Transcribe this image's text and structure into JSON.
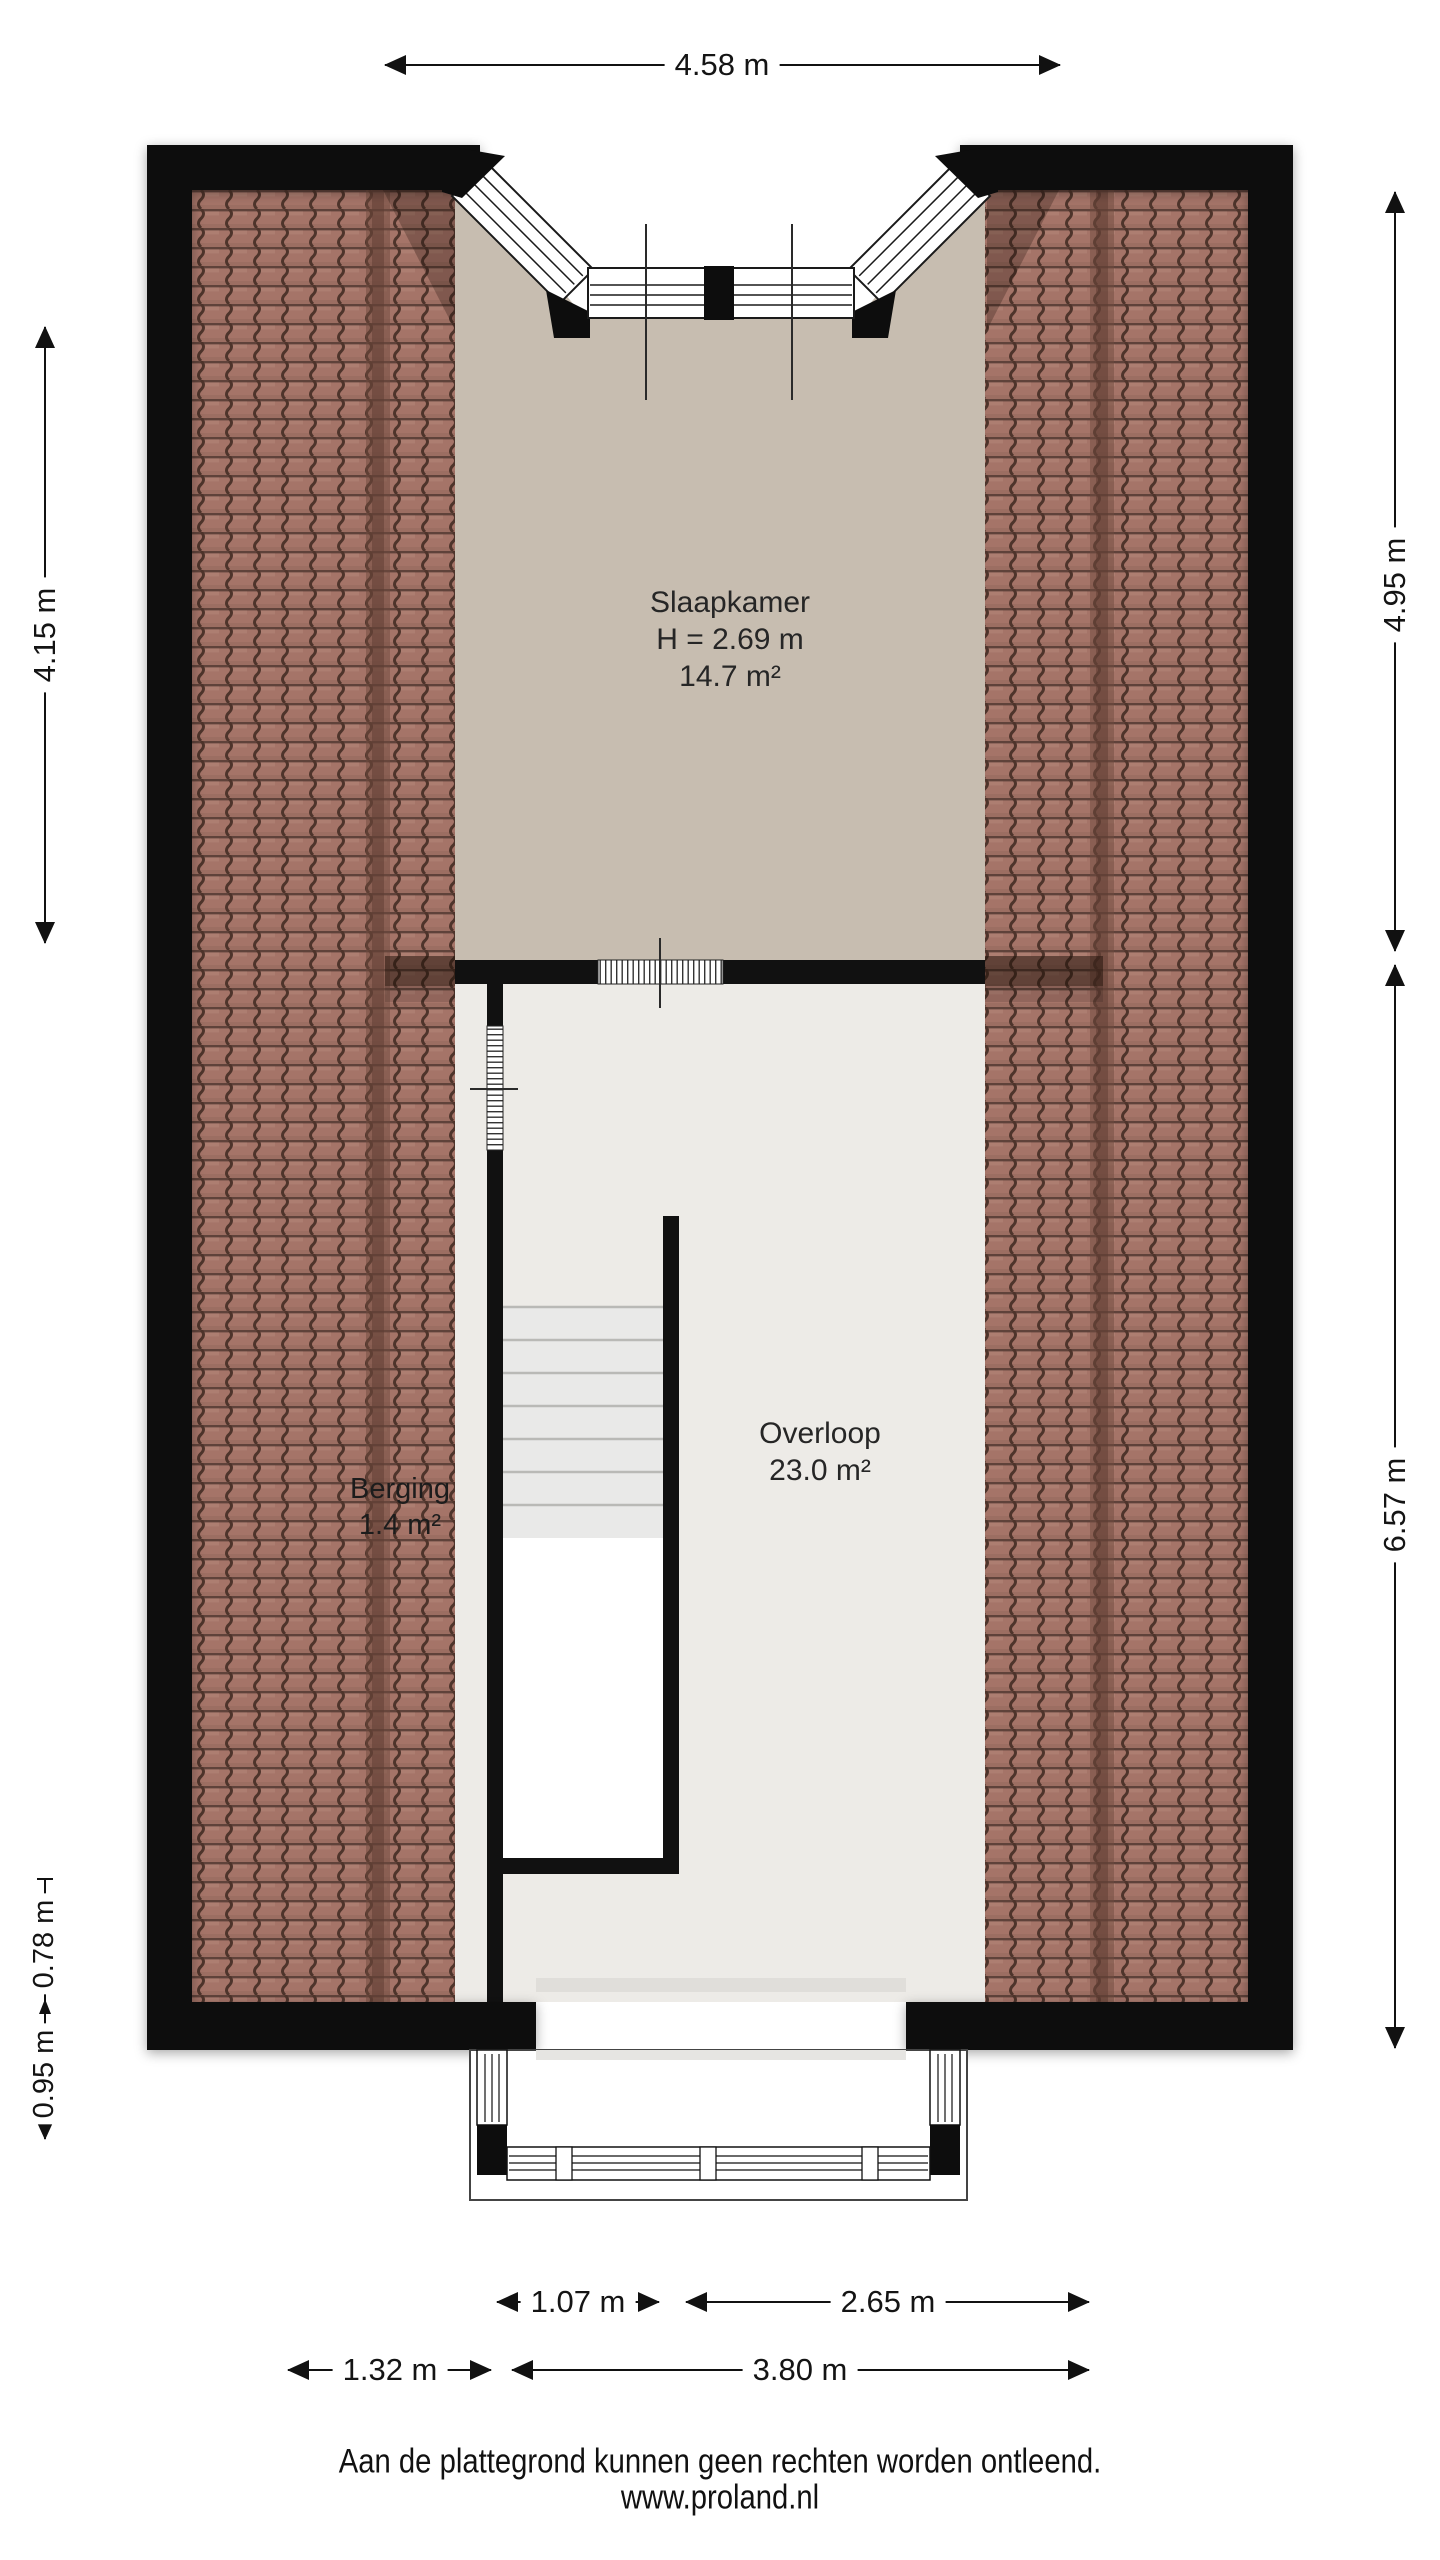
{
  "dimensions": {
    "top": "4.58 m",
    "left": "4.15 m",
    "right_upper": "4.95 m",
    "right_lower": "6.57 m",
    "left_lower_upper": "0.78 m",
    "left_lower_lower": "0.95 m",
    "bottom_inner_left": "1.07 m",
    "bottom_inner_right": "2.65 m",
    "bottom_outer_left": "1.32 m",
    "bottom_outer_right": "3.80 m"
  },
  "rooms": {
    "slaapkamer": {
      "name": "Slaapkamer",
      "ceiling_height": "H = 2.69 m",
      "area": "14.7 m²"
    },
    "overloop": {
      "name": "Overloop",
      "area": "23.0 m²"
    },
    "berging": {
      "name": "Berging",
      "area": "1.4 m²"
    }
  },
  "footer": {
    "disclaimer": "Aan de plattegrond kunnen geen rechten worden ontleend.",
    "website": "www.proland.nl"
  },
  "colors": {
    "wall": "#111111",
    "roof_tiles": "#a57468",
    "slaapkamer_floor": "#c7bdb0",
    "overloop_floor": "#edebe7",
    "background": "#ffffff"
  }
}
